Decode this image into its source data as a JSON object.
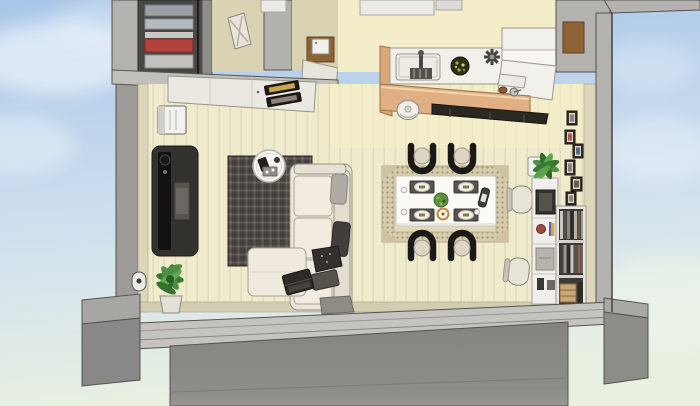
{
  "scene": {
    "type": "3d-home-cutaway-render",
    "view": "top-down dollhouse view of a one-story living-dining-kitchen interior, walls cut away, floating over a sky background with concrete foundation blocks below",
    "rooms": [
      {
        "name": "entry-hall",
        "objects": [
          "closet-with-clothes",
          "leaning-panel",
          "white-wall-cabinet",
          "appliance-cabinet",
          "cooktop-counter"
        ]
      },
      {
        "name": "living-room",
        "objects": [
          "wall-mounted-ac",
          "tv-sideboard",
          "plaid-rug",
          "round-coffee-table",
          "l-shaped-sofa",
          "ottoman",
          "laptop",
          "throw-pillows",
          "floor-potted-plant",
          "door-mat"
        ]
      },
      {
        "name": "dining-room",
        "objects": [
          "patterned-rug",
          "dining-table",
          "dining-chairs-x4",
          "place-settings-x4",
          "salad-centerpiece",
          "drink-bottle"
        ]
      },
      {
        "name": "kitchen",
        "objects": [
          "island-counter",
          "island-sink",
          "dish-rack",
          "salad-bowl",
          "star-faucet",
          "wood-bar-counter",
          "counter-stool",
          "cooktop-strip",
          "back-counter",
          "refrigerator",
          "top-cabinets"
        ]
      },
      {
        "name": "study-corner",
        "objects": [
          "desk-chairs-x2",
          "desk-hutch-cabinet",
          "plant-on-cabinet",
          "bookshelf",
          "wicker-basket",
          "picture-frames-x6"
        ]
      }
    ],
    "structure": [
      "cut-wall-tops",
      "wood-plank-floor",
      "foundation-blocks",
      "sky-with-clouds"
    ]
  },
  "colors": {
    "sky_top": "#a7c6e8",
    "sky_mid": "#cfdfef",
    "sky_bottom": "#e9f0e2",
    "cloud": "#ffffff",
    "wall_cut": "#b4b2ae",
    "wall_cut_dark": "#8f8d89",
    "wall_inner": "#dcd6ba",
    "wall_outline": "#55534f",
    "floor": "#f1ebcd",
    "floor_stripe": "#e2dcbf",
    "kitchen_floor": "#f3edc9",
    "hallway_floor": "#d9d3b3",
    "closet_dark": "#4a4846",
    "clothes_red": "#b5413b",
    "clothes_gray": "#9aa0a4",
    "fridge_brown": "#8f6236",
    "counter_white": "#f2f0ea",
    "counter_wood": "#e0b084",
    "stove_dark": "#1d1b18",
    "stove_gold": "#c9a64e",
    "sink_gray": "#edebe5",
    "bowl_dark": "#332d13",
    "salad_green": "#8fb54a",
    "stool_white": "#f0eee9",
    "tv_body": "#34322f",
    "tv_screen": "#121110",
    "rug_dark": "#45413c",
    "rug_grid": "#5f5952",
    "sofa_cream": "#ece7db",
    "sofa_line": "#97927f",
    "pillow_dark": "#413e3b",
    "laptop_dark": "#2d2b28",
    "table_round": "#f6f5f1",
    "dining_rug": "#d6cbac",
    "dining_rug_pattern": "#a39574",
    "dining_table": "#fbfaf6",
    "placemat": "#56524c",
    "plate": "#f1efe9",
    "chair_black": "#1b1917",
    "chair_seat": "#ddd6c2",
    "centerpiece_green": "#5d8f3d",
    "office_chair": "#e8e4d8",
    "cabinet_white": "#f1efeb",
    "plant_green": "#4e8f45",
    "frame_dark": "#3a2f26",
    "basket": "#c9a878",
    "ac_white": "#f2f1ed",
    "foundation": "#8e8c88",
    "foundation_front": "#8a8886",
    "foundation_light": "#a8a6a2",
    "band_gray": "#c5c3bf"
  }
}
